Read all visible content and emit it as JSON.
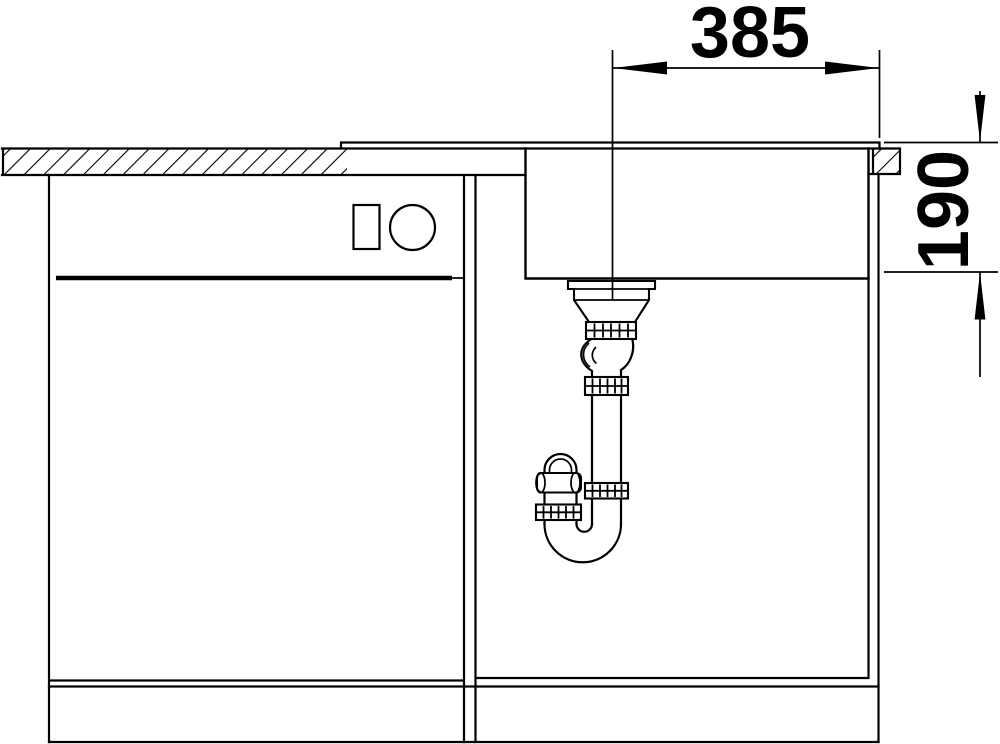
{
  "figure": {
    "kind": "technical installation drawing",
    "subject": "kitchen sink cross-section with waste siphon and base cabinets",
    "background_color": "#ffffff",
    "line_color": "#000000"
  },
  "dimensions": {
    "horizontal": {
      "value": "385",
      "measured": "drain centreline to right worktop edge"
    },
    "vertical": {
      "value": "190",
      "measured": "rim top to bowl bottom"
    }
  }
}
